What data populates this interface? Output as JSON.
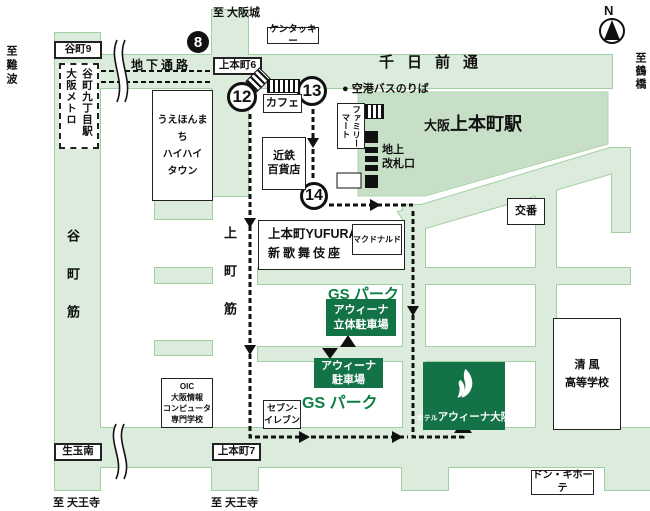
{
  "colors": {
    "road_fill": "#dcecdc",
    "road_border": "#a2cfa2",
    "station_fill": "#c6dfc6",
    "brand_green": "#147247",
    "gs_text_green": "#0a7f42",
    "route_black": "#111111"
  },
  "compass": {
    "label": "N"
  },
  "directions": {
    "osaka_castle": "至 大阪城",
    "namba": "至難波",
    "tsuruhashi": "至鶴橋",
    "tennoji_west": "至 天王寺",
    "tennoji_east": "至 天王寺"
  },
  "roads": {
    "sennichimae": "千日前通",
    "tanimachi_suji": "谷町筋",
    "uemachi_suji": "上町筋",
    "underground_passage": "地下通路"
  },
  "intersections": {
    "tanimachi9": "谷町9",
    "uehommachi6": "上本町6",
    "uehommachi7": "上本町7",
    "ikutama_minami": "生玉南"
  },
  "station": {
    "name_prefix": "大阪",
    "name_main": "上本町駅",
    "metro_col1": "大阪メトロ",
    "metro_col2": "谷町九丁目駅",
    "ground_gate_line1": "地上",
    "ground_gate_line2": "改札口",
    "airport_bus_bullet": "●",
    "airport_bus_stop": "空港バスのりば"
  },
  "route_numbers": {
    "exit8": "8",
    "point12": "12",
    "point13": "13",
    "point14": "14"
  },
  "landmarks": {
    "kfc": "ケンタッキー",
    "cafe": "カフェ",
    "kintetsu_line1": "近鉄",
    "kintetsu_line2": "百貨店",
    "hihi_line1": "うえほんまち",
    "hihi_line2": "ハイハイ",
    "hihi_line3": "タウン",
    "famima": "ファミリーマート",
    "yufura_line1": "上本町YUFURA",
    "yufura_line2": "新歌舞伎座",
    "mcdonalds": "マクドナルド",
    "koban": "交番",
    "seven_line1": "セブン-",
    "seven_line2": "イレブン",
    "oic_line1": "OIC",
    "oic_line2": "大阪情報",
    "oic_line3": "コンピュータ",
    "oic_line4": "専門学校",
    "seifu_line1": "清 風",
    "seifu_line2": "高等学校",
    "donki": "ドン・キホーテ"
  },
  "parking": {
    "gs_park_upper": "GS パーク",
    "gs_park_lower": "GS パーク",
    "rittai_line1": "アウィーナ",
    "rittai_line2": "立体駐車場",
    "lot_line1": "アウィーナ",
    "lot_line2": "駐車場"
  },
  "hotel": {
    "prefix": "ホテル",
    "name": "アウィーナ大阪"
  }
}
